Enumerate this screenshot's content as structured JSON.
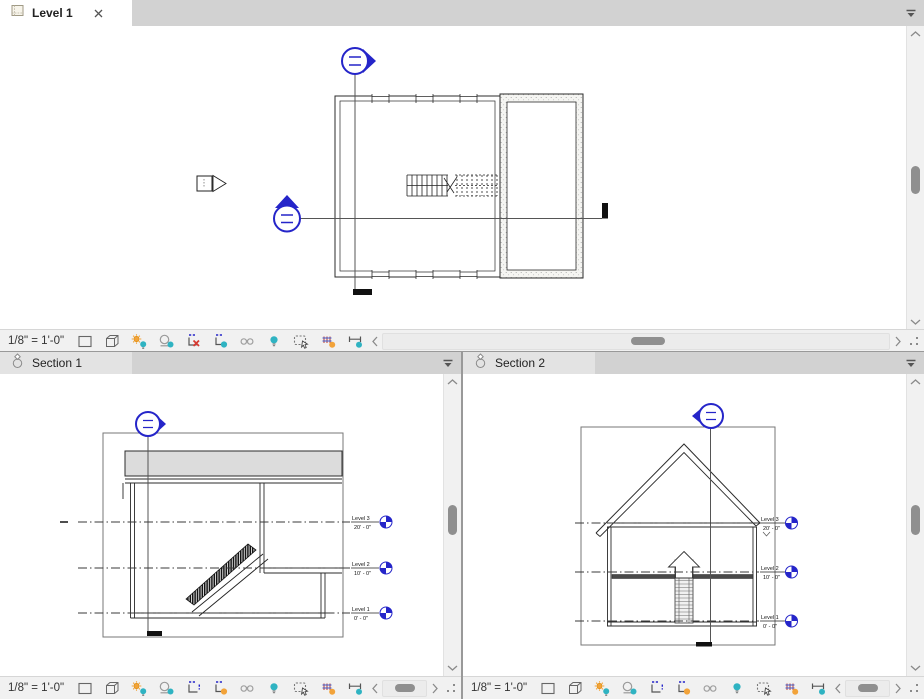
{
  "colors": {
    "teal": "#2fb3c2",
    "orange": "#f2a33a",
    "red": "#d63a31",
    "marker_blue": "#2525c9",
    "roof_gray": "#dcdcdc"
  },
  "panes": {
    "plan": {
      "tab_label": "Level 1",
      "close_glyph": "✕",
      "scale": "1/8\" = 1'-0\"",
      "crop_state": "crop-inactive-red-x",
      "crop_region_dot": "teal"
    },
    "section1": {
      "tab_label": "Section 1",
      "scale": "1/8\" = 1'-0\"",
      "crop_state": "crop-active",
      "crop_region_dot": "orange"
    },
    "section2": {
      "tab_label": "Section 2",
      "scale": "1/8\" = 1'-0\"",
      "crop_state": "crop-active",
      "crop_region_dot": "orange"
    }
  },
  "levels": [
    {
      "name": "Level 3",
      "elevation": "20' - 0\""
    },
    {
      "name": "Level 2",
      "elevation": "10' - 0\""
    },
    {
      "name": "Level 1",
      "elevation": "0' - 0\""
    }
  ],
  "vcb_icons": [
    {
      "name": "detail-level"
    },
    {
      "name": "visual-style"
    },
    {
      "name": "sun-path"
    },
    {
      "name": "shadows"
    },
    {
      "name": "crop-view"
    },
    {
      "name": "show-crop-region"
    },
    {
      "name": "temporary-hide-isolate"
    },
    {
      "name": "reveal-hidden-elements"
    },
    {
      "name": "temporary-view-properties"
    },
    {
      "name": "analytical-model"
    },
    {
      "name": "reveal-constraints"
    }
  ]
}
